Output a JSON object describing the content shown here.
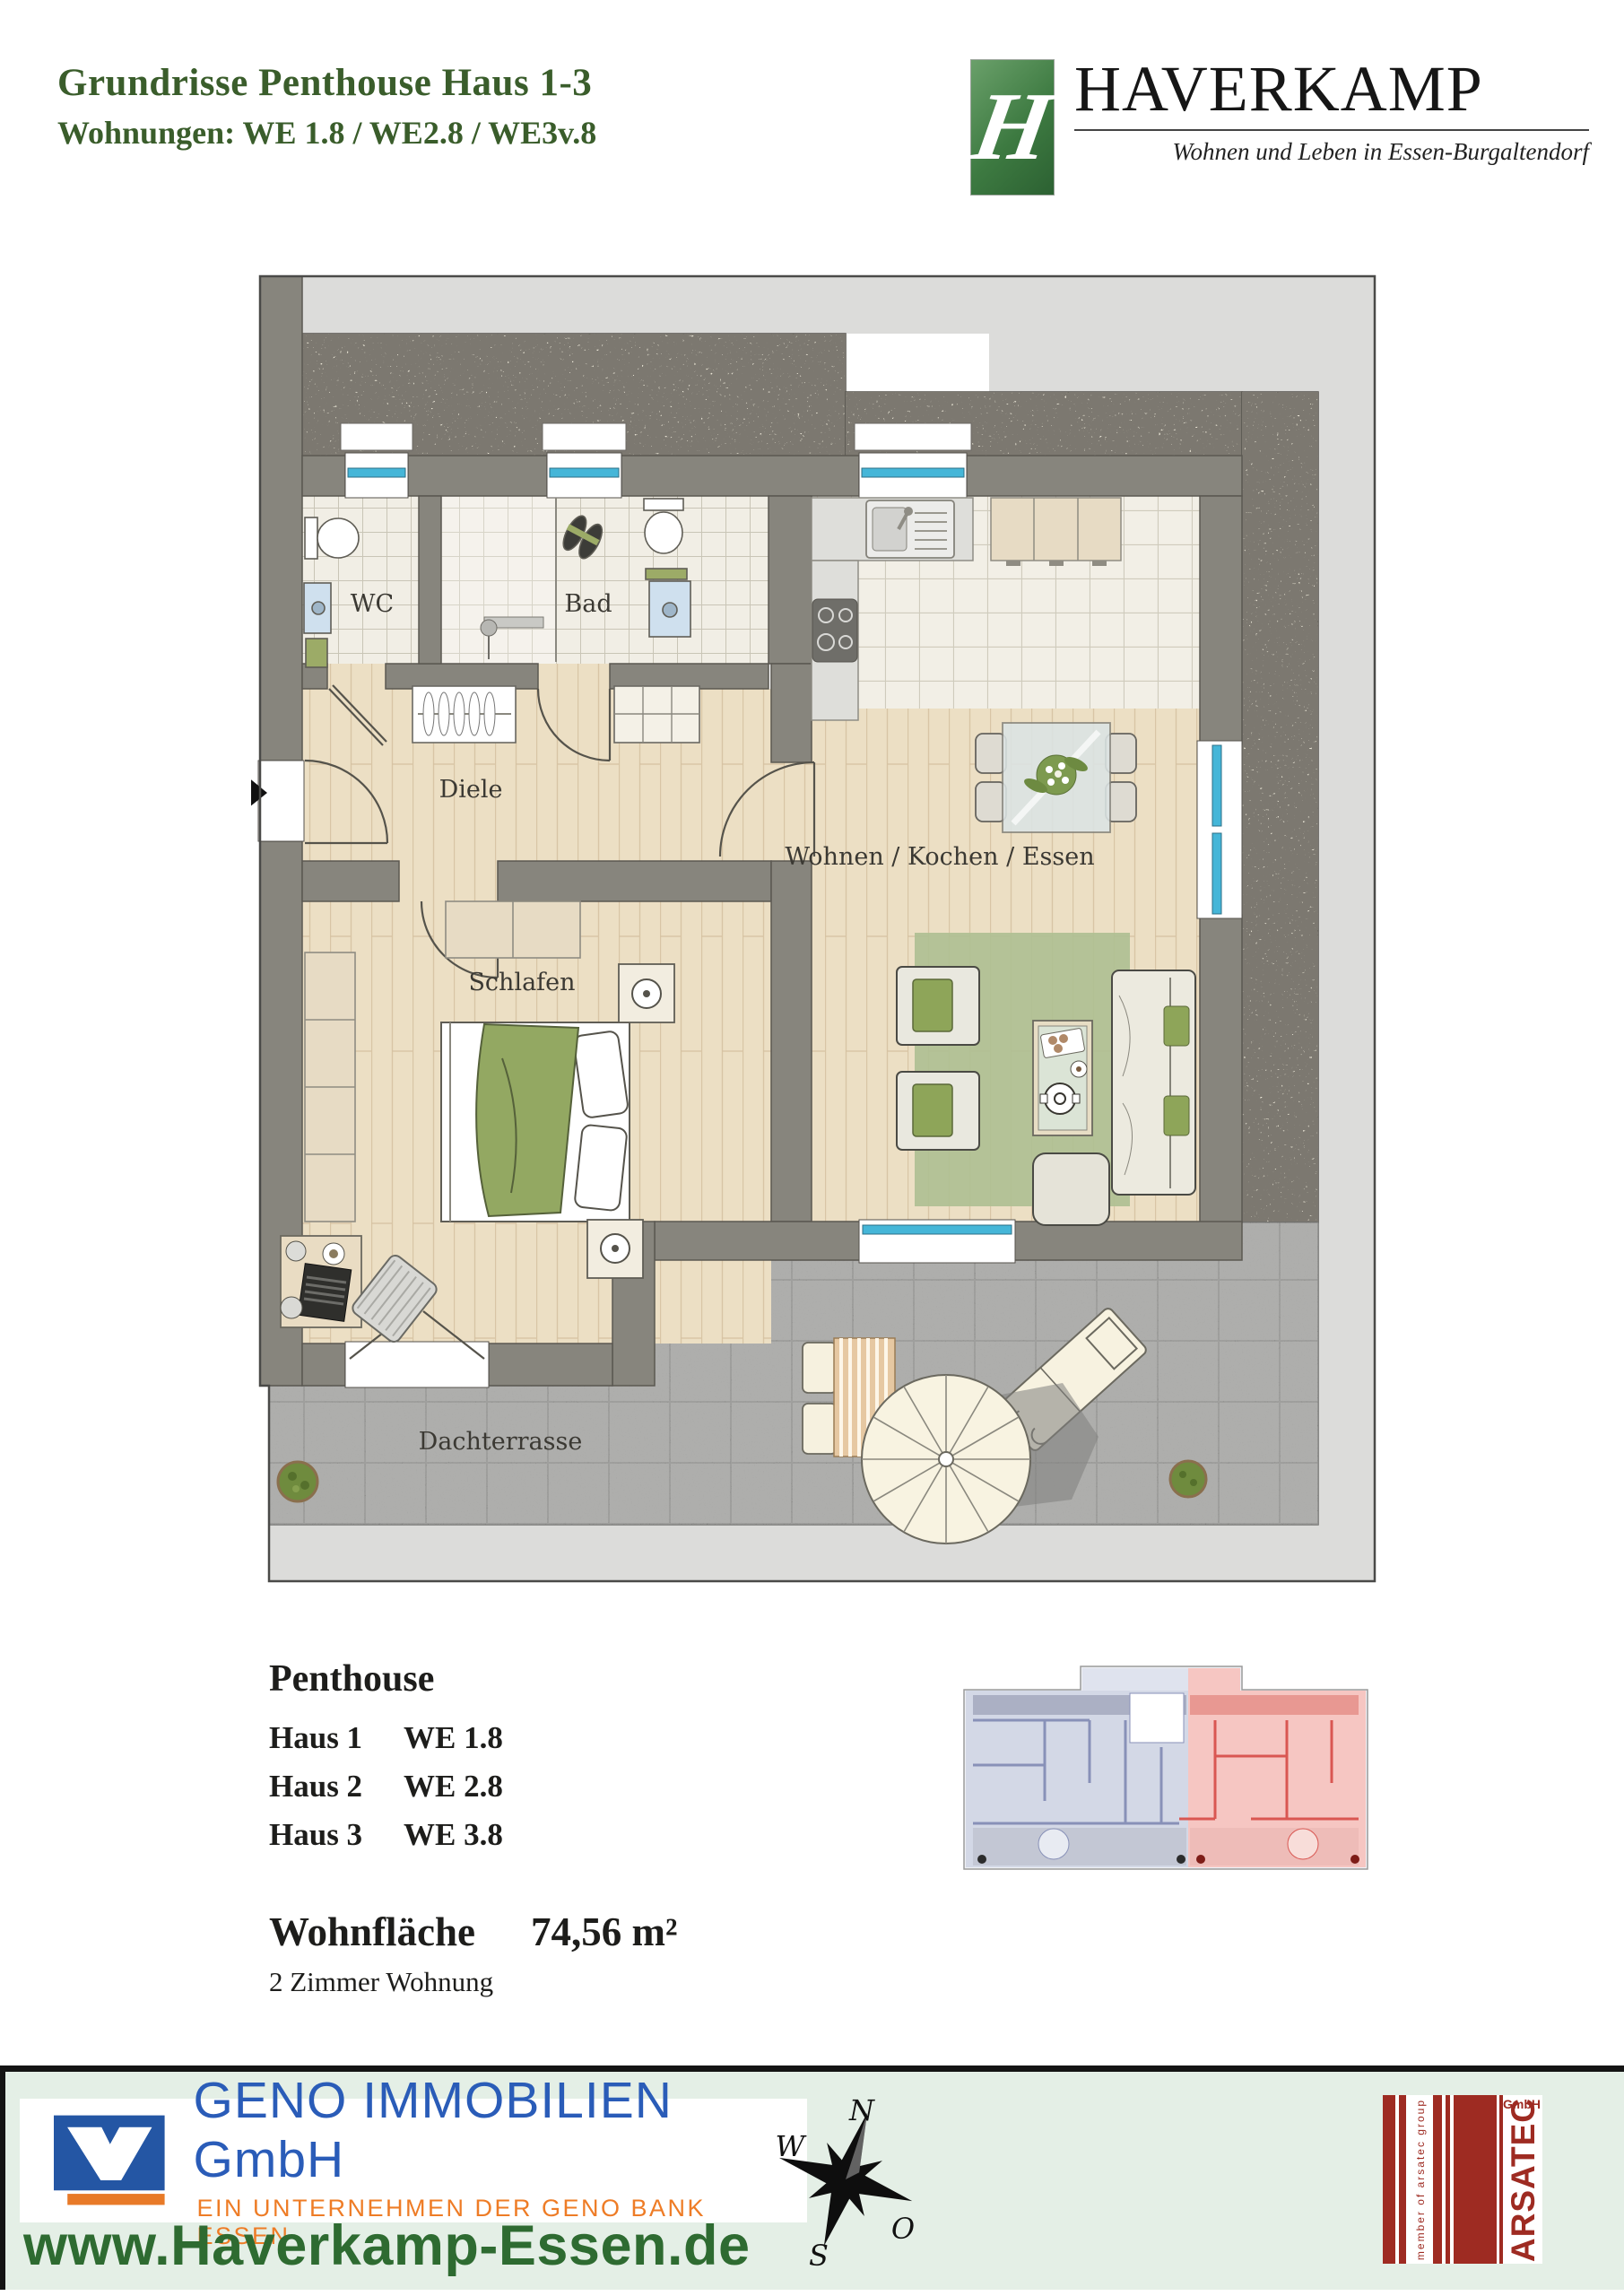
{
  "header": {
    "title_line1": "Grundrisse Penthouse Haus 1-3",
    "title_line2": "Wohnungen:  WE 1.8 / WE2.8 / WE3v.8"
  },
  "logo": {
    "monogram": "H",
    "name": "HAVERKAMP",
    "tagline": "Wohnen und Leben in Essen-Burgaltendorf"
  },
  "plan": {
    "rooms": {
      "wc": "WC",
      "bad": "Bad",
      "diele": "Diele",
      "schlafen": "Schlafen",
      "wohnen": "Wohnen / Kochen / Essen",
      "dachterrasse": "Dachterrasse"
    }
  },
  "details": {
    "heading": "Penthouse",
    "units": [
      {
        "haus": "Haus 1",
        "we": "WE 1.8"
      },
      {
        "haus": "Haus 2",
        "we": "WE 2.8"
      },
      {
        "haus": "Haus 3",
        "we": "WE 3.8"
      }
    ],
    "area_label": "Wohnfläche",
    "area_value": "74,56 m²",
    "apartment_type": "2 Zimmer Wohnung"
  },
  "footer": {
    "geno": {
      "name": "GENO IMMOBILIEN GmbH",
      "subtitle": "EIN UNTERNEHMEN DER GENO BANK ESSEN"
    },
    "website": "www.Haverkamp-Essen.de",
    "compass": {
      "n": "N",
      "w": "W",
      "o": "O",
      "s": "S"
    },
    "arsatec": {
      "name": "ARSATEC",
      "gmbh": "GmbH",
      "member": "member of arsatec group"
    }
  },
  "colors": {
    "title_green": "#3a5d2b",
    "brand_green": "#3d7a41",
    "window_cyan": "#45b6d8",
    "wall_gray": "#87857d",
    "footer_green": "#e4efe6",
    "geno_blue": "#2a5cb8",
    "geno_orange": "#ee7c26",
    "arsatec_red": "#9e2b22",
    "web_green": "#2e6b31"
  }
}
